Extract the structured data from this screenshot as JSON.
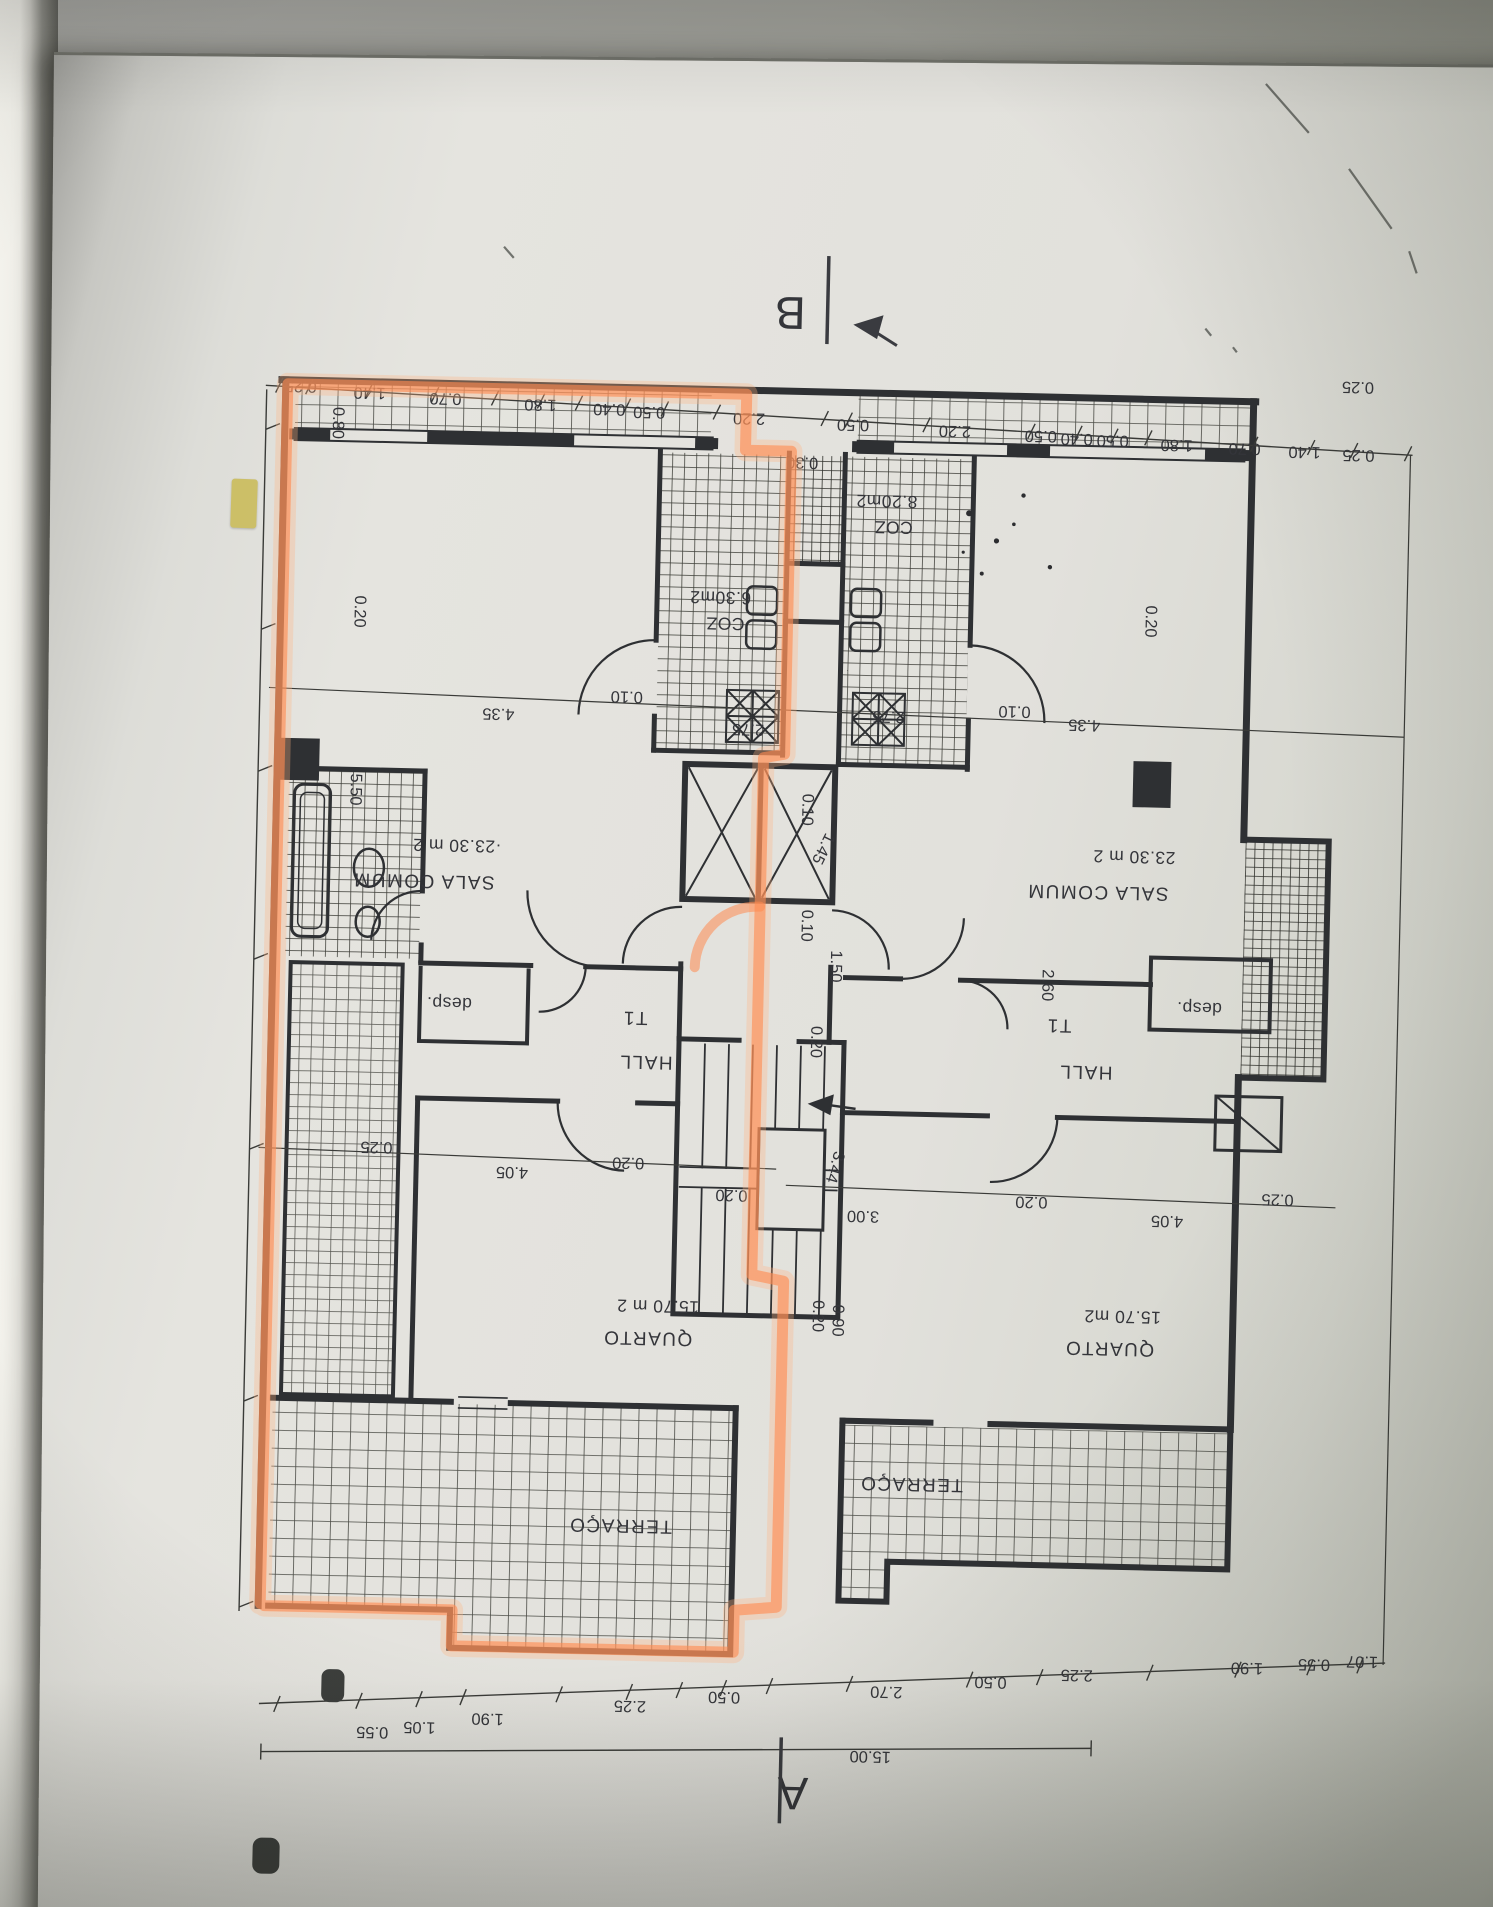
{
  "style": {
    "highlight_color": "#ff8a50",
    "ink_color": "#2e3033",
    "paper_color": "#e2e1dc",
    "tab_color": "#c9ba54"
  },
  "markers": {
    "section_b": "B",
    "section_a": "A"
  },
  "rooms": {
    "left": {
      "sala_area": "·23.30 m 2",
      "sala": "SALA COMUM",
      "coz_area": "6.30m2",
      "coz": "COZ",
      "t1": "T1",
      "hall": "HALL",
      "desp": "desp.",
      "quarto_area": "15.70 m 2",
      "quarto": "QUARTO",
      "terraco": "TERRAÇO"
    },
    "right": {
      "sala_area": "23.30 m 2",
      "sala": "SALA COMUM",
      "coz_area": "8.20m2",
      "coz": "COZ",
      "t1": "T1",
      "hall": "HALL",
      "desp": "desp.",
      "quarto_area": "15.70 m2",
      "quarto": "QUARTO",
      "terraco": "TERRAÇO"
    }
  },
  "dims": {
    "top": [
      "0.25",
      "1.40",
      "0.70",
      "1.80",
      "0.40",
      "0.50",
      "2.20",
      "0.50",
      "2.20",
      "0.50",
      "0.40",
      "0.50",
      "1.80",
      "0.70",
      "1.40",
      "0.25"
    ],
    "left_col": [
      "0.80",
      "0.20",
      "5.50"
    ],
    "chain_upper": [
      "4.35",
      "0.10",
      "2.75",
      "2.75",
      "0.10",
      "4.35"
    ],
    "right_col": [
      "0.20",
      "0.25"
    ],
    "shaft": "0.30",
    "core": {
      "d1": "1.45",
      "d2": "0.10",
      "d3": "0.10",
      "d4": "1.50",
      "d5": "0.20",
      "d6": "2.60",
      "d7": "3.44",
      "d8": "3.00",
      "d9": "0.20",
      "d10": "0.20",
      "d11": "0.90"
    },
    "chain_mid_left": [
      "0.25",
      "4.05",
      "0.20"
    ],
    "chain_mid_right": [
      "0.20",
      "4.05",
      "0.25"
    ],
    "bottom": [
      "0.55",
      "1.05",
      "1.90",
      "2.25",
      "0.50",
      "2.70",
      "0.50",
      "2.25",
      "1.90",
      "0.55",
      "1.07"
    ],
    "total_width": "15.00"
  }
}
